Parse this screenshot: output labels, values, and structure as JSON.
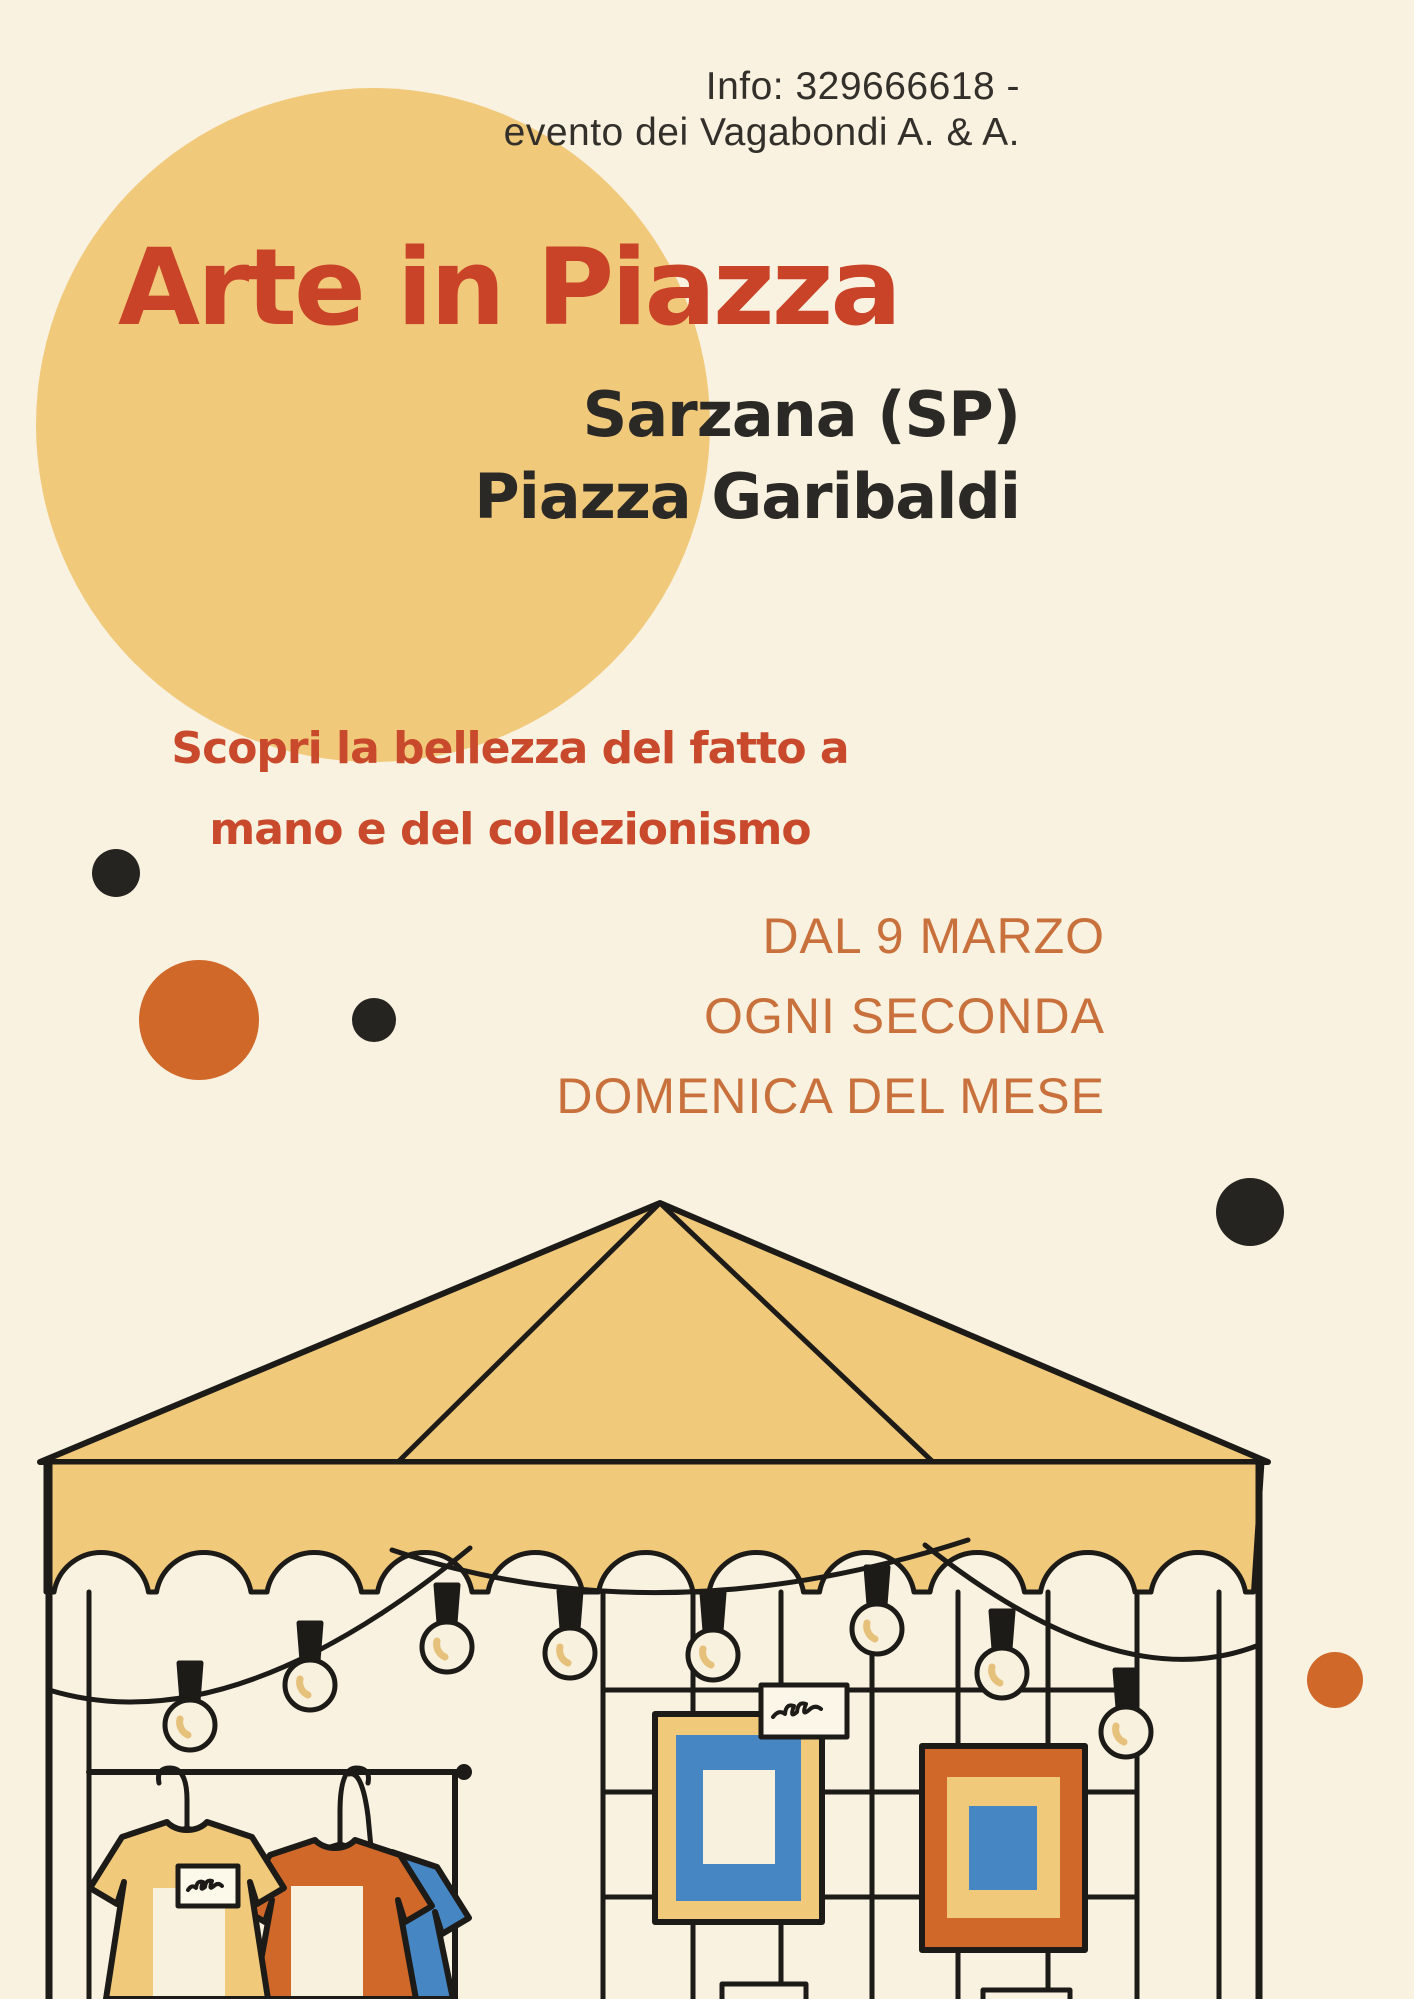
{
  "poster": {
    "info": {
      "line1": "Info: 329666618 -",
      "line2": "evento dei Vagabondi A. & A."
    },
    "title": "Arte in Piazza",
    "location": {
      "line1": "Sarzana (SP)",
      "line2": "Piazza Garibaldi"
    },
    "tagline": {
      "line1": "Scopri la bellezza del fatto a",
      "line2": "mano e del collezionismo"
    },
    "schedule": {
      "line1": "DAL 9 MARZO",
      "line2": "OGNI SECONDA",
      "line3": "DOMENICA DEL MESE"
    }
  },
  "palette": {
    "background": "#f9f2e0",
    "sun_yellow": "#f1c97b",
    "title_red": "#c94328",
    "tagline_red": "#c8492b",
    "text_dark": "#2b2925",
    "schedule_orange": "#c8713c",
    "accent_orange": "#d0682a",
    "accent_blue": "#4687c3",
    "outline_black": "#1d1b18",
    "cream": "#f8f1dd",
    "bulb_filament": "#e6c17c"
  },
  "illustration": {
    "icons": [
      "market-tent-icon",
      "scalloped-valance-icon",
      "string-lights-icon",
      "light-bulb-icon",
      "clothes-rack-icon",
      "tshirt-icon",
      "picture-frame-icon",
      "price-sign-icon"
    ],
    "bulb_count": 8,
    "tshirt_count": 3,
    "frame_count": 2
  }
}
